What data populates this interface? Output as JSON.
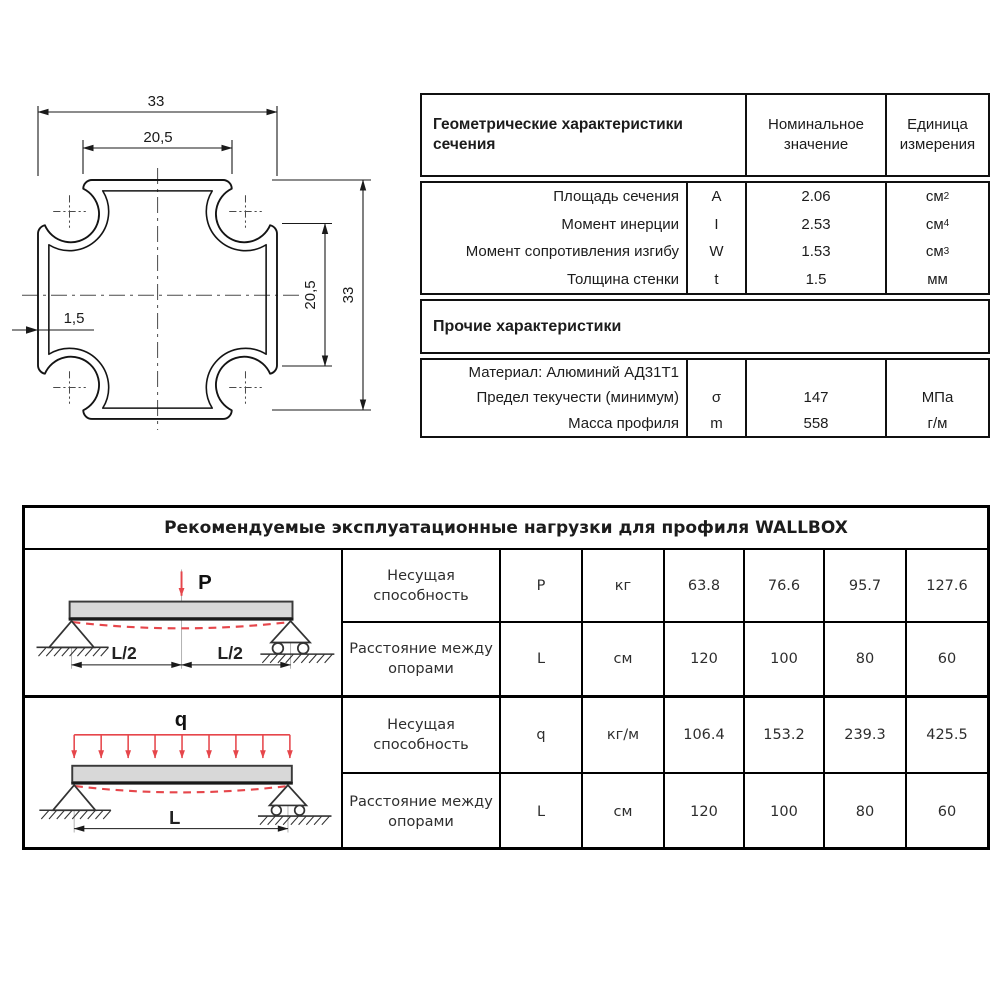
{
  "drawing": {
    "dim_overall_width": "33",
    "dim_arm_width": "20,5",
    "dim_arm_height": "20,5",
    "dim_overall_height": "33",
    "dim_wall_thickness": "1,5"
  },
  "geometry_table": {
    "header": {
      "title": "Геометрические характеристики сечения",
      "nominal": "Номинальное значение",
      "unit": "Единица измерения"
    },
    "rows": [
      {
        "label": "Площадь сечения",
        "symbol": "A",
        "value": "2.06",
        "unit_base": "см",
        "unit_sup": "2"
      },
      {
        "label": "Момент инерции",
        "symbol": "I",
        "value": "2.53",
        "unit_base": "см",
        "unit_sup": "4"
      },
      {
        "label": "Момент сопротивления изгибу",
        "symbol": "W",
        "value": "1.53",
        "unit_base": "см",
        "unit_sup": "3"
      },
      {
        "label": "Толщина стенки",
        "symbol": "t",
        "value": "1.5",
        "unit_base": "мм",
        "unit_sup": ""
      }
    ],
    "other_title": "Прочие характеристики",
    "other_rows": [
      {
        "label": "Материал: Алюминий АД31Т1",
        "symbol": "",
        "value": "",
        "unit_base": "",
        "unit_sup": ""
      },
      {
        "label": "Предел текучести (минимум)",
        "symbol": "σ",
        "value": "147",
        "unit_base": "МПа",
        "unit_sup": ""
      },
      {
        "label": "Масса профиля",
        "symbol": "m",
        "value": "558",
        "unit_base": "г/м",
        "unit_sup": ""
      }
    ]
  },
  "loads_table": {
    "title": "Рекомендуемые эксплуатационные нагрузки для профиля WALLBOX",
    "sections": [
      {
        "diagram_labels": {
          "force": "P",
          "span_left": "L/2",
          "span_right": "L/2"
        },
        "rows": [
          {
            "label": "Несущая способность",
            "symbol": "P",
            "unit": "кг",
            "values": [
              "63.8",
              "76.6",
              "95.7",
              "127.6"
            ]
          },
          {
            "label": "Расстояние между опорами",
            "symbol": "L",
            "unit": "см",
            "values": [
              "120",
              "100",
              "80",
              "60"
            ]
          }
        ]
      },
      {
        "diagram_labels": {
          "force": "q",
          "span": "L"
        },
        "rows": [
          {
            "label": "Несущая способность",
            "symbol": "q",
            "unit": "кг/м",
            "values": [
              "106.4",
              "153.2",
              "239.3",
              "425.5"
            ]
          },
          {
            "label": "Расстояние между опорами",
            "symbol": "L",
            "unit": "см",
            "values": [
              "120",
              "100",
              "80",
              "60"
            ]
          }
        ]
      }
    ]
  },
  "colors": {
    "accent_red": "#e6464b",
    "beam_fill": "#d8d8d8",
    "line_black": "#101010"
  }
}
